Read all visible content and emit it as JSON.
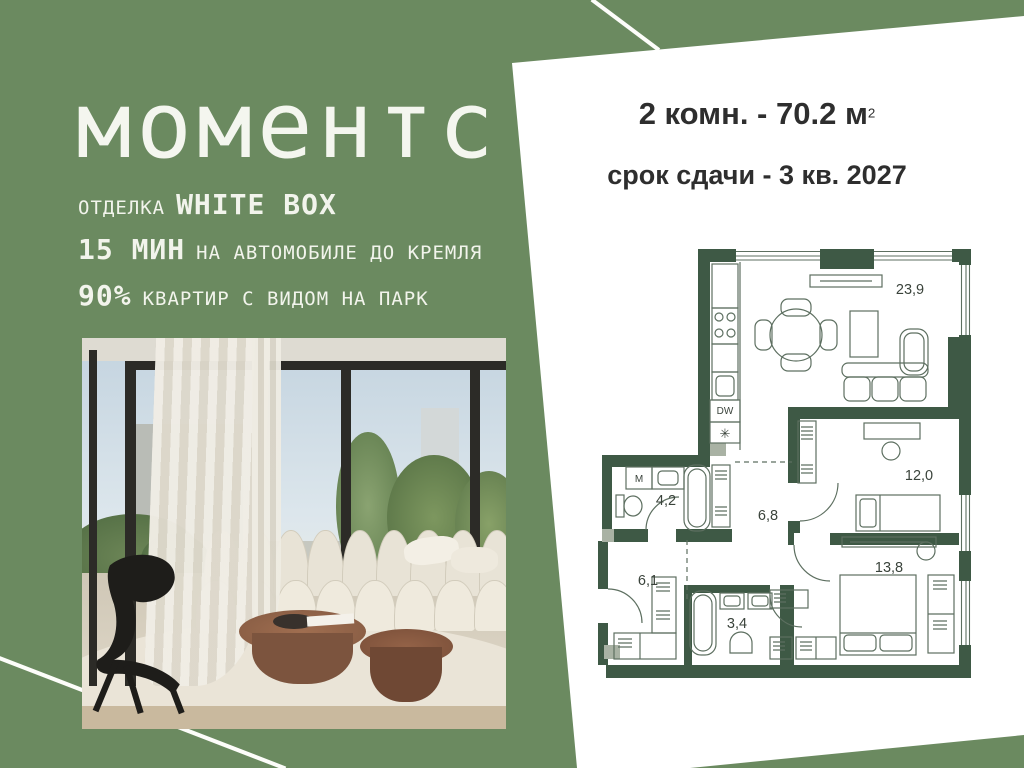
{
  "background": {
    "color": "#6b8a60"
  },
  "logo": {
    "text": "моментс"
  },
  "features": [
    {
      "small": "ОТДЕЛКА",
      "big": "WHITE BOX"
    },
    {
      "big": "15 МИН",
      "small": "НА АВТОМОБИЛЕ ДО КРЕМЛЯ"
    },
    {
      "big": "90%",
      "small": "КВАРТИР С ВИДОМ НА ПАРК"
    }
  ],
  "card": {
    "title": "2 комн. - 70.2 м",
    "title_sup": "2",
    "subtitle": "срок сдачи - 3 кв. 2027",
    "bg": "#ffffff",
    "text_color": "#2e2e2e"
  },
  "plan": {
    "wall_color": "#3e5945",
    "line_color": "#5d6f60",
    "label_color": "#3a433b",
    "rooms": [
      {
        "name": "living-kitchen",
        "area": "23,9"
      },
      {
        "name": "bedroom-small",
        "area": "12,0"
      },
      {
        "name": "bedroom-master",
        "area": "13,8"
      },
      {
        "name": "hall",
        "area": "6,8"
      },
      {
        "name": "bathroom",
        "area": "4,2"
      },
      {
        "name": "entry-hall",
        "area": "6,1"
      },
      {
        "name": "bathroom-guest",
        "area": "3,4"
      }
    ],
    "fixtures": {
      "dishwasher": "DW",
      "washer": "М",
      "cooktop": "✳"
    }
  }
}
